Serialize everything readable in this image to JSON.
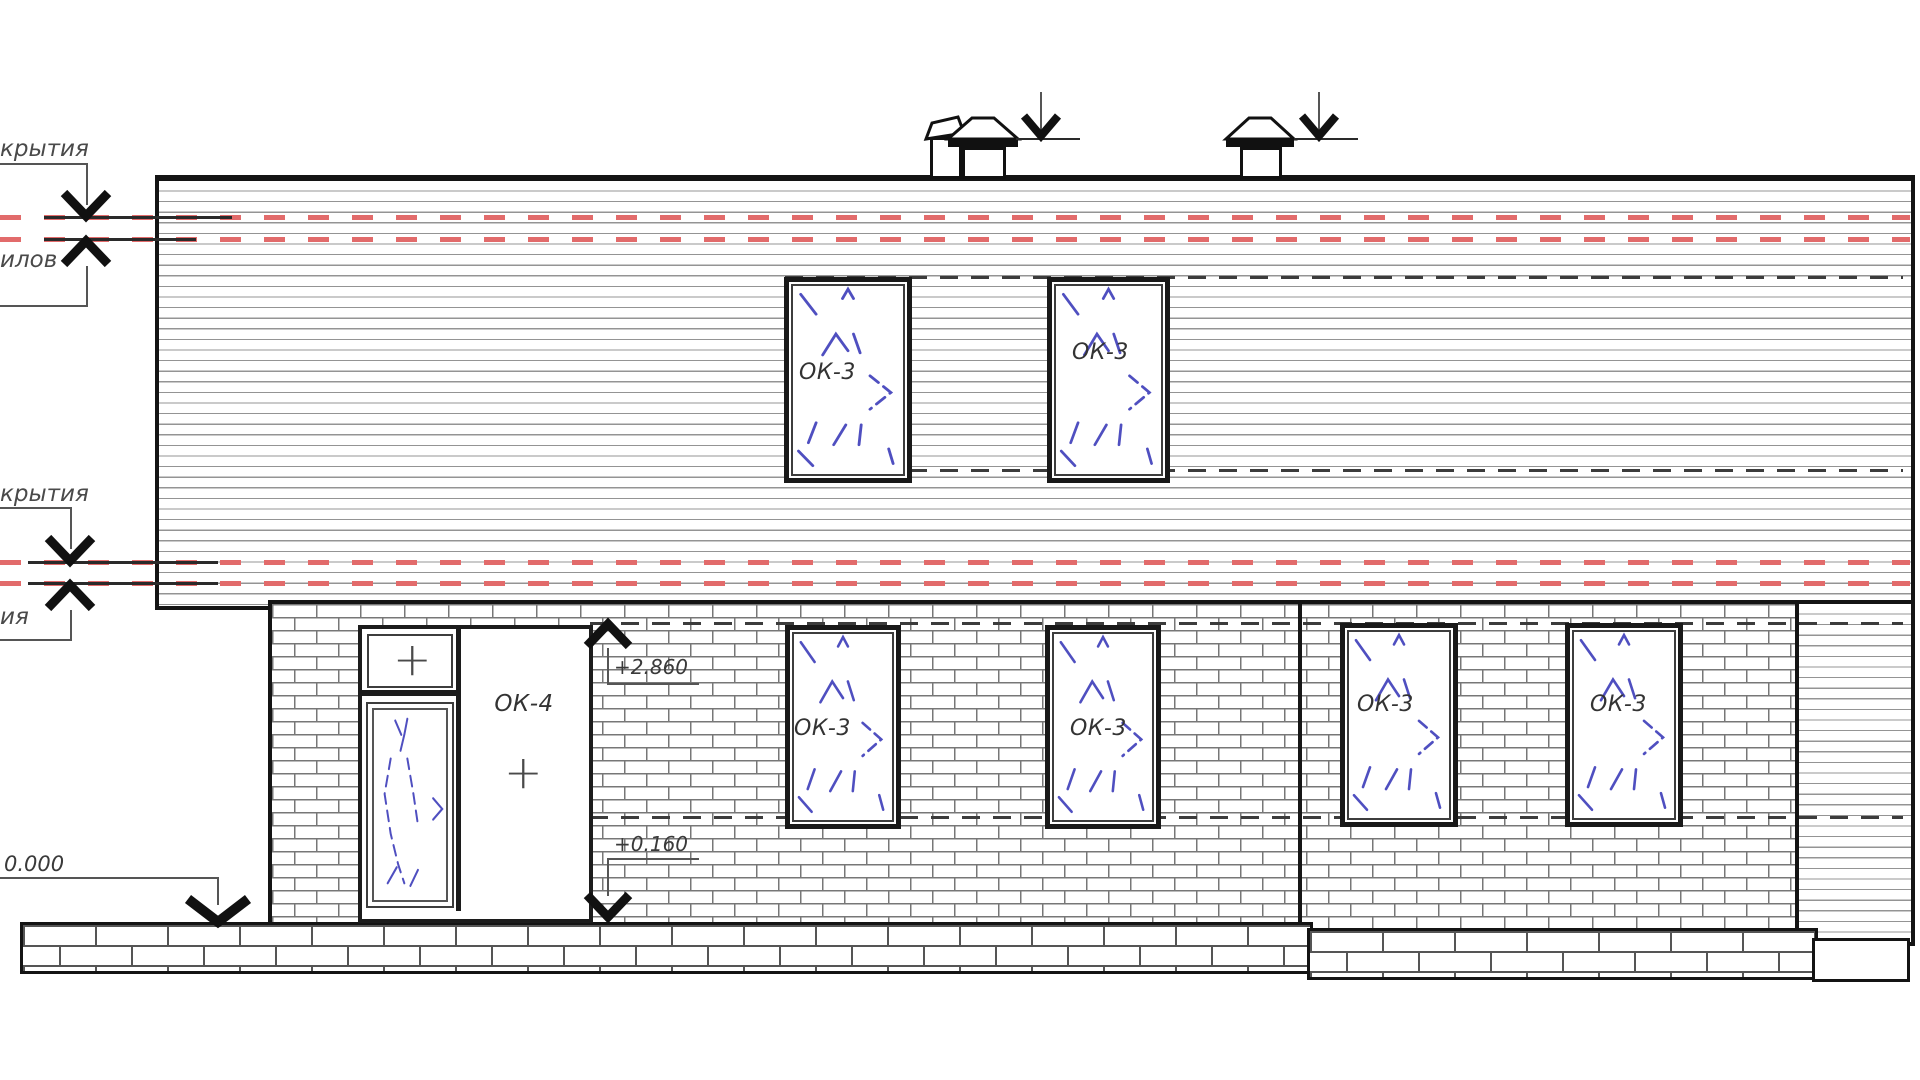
{
  "labels": {
    "roof_annotation_top": "крытия",
    "roof_annotation_top_hidden": "илов",
    "roof_annotation_mid": "крытия",
    "roof_annotation_mid_hidden": "ия",
    "ground_elevation": "0.000",
    "door_head_elevation": "+2.860",
    "door_sill_elevation": "+0.160"
  },
  "windows": [
    {
      "id": "upper-left",
      "label": "ОК-3"
    },
    {
      "id": "upper-right",
      "label": "ОК-3"
    },
    {
      "id": "first-floor-1",
      "label": "ОК-3"
    },
    {
      "id": "first-floor-2",
      "label": "ОК-3"
    },
    {
      "id": "first-floor-3",
      "label": "ОК-3"
    },
    {
      "id": "first-floor-4",
      "label": "ОК-3"
    }
  ],
  "door": {
    "label": "ОК-4",
    "transom_mark": "+",
    "panel_mark": "+"
  },
  "colors": {
    "line": "#141414",
    "red_level_dash": "#e26b6b",
    "blue_opening_symbol": "#4f4fc0",
    "siding_line": "#949494",
    "brick_joint": "#777777"
  }
}
